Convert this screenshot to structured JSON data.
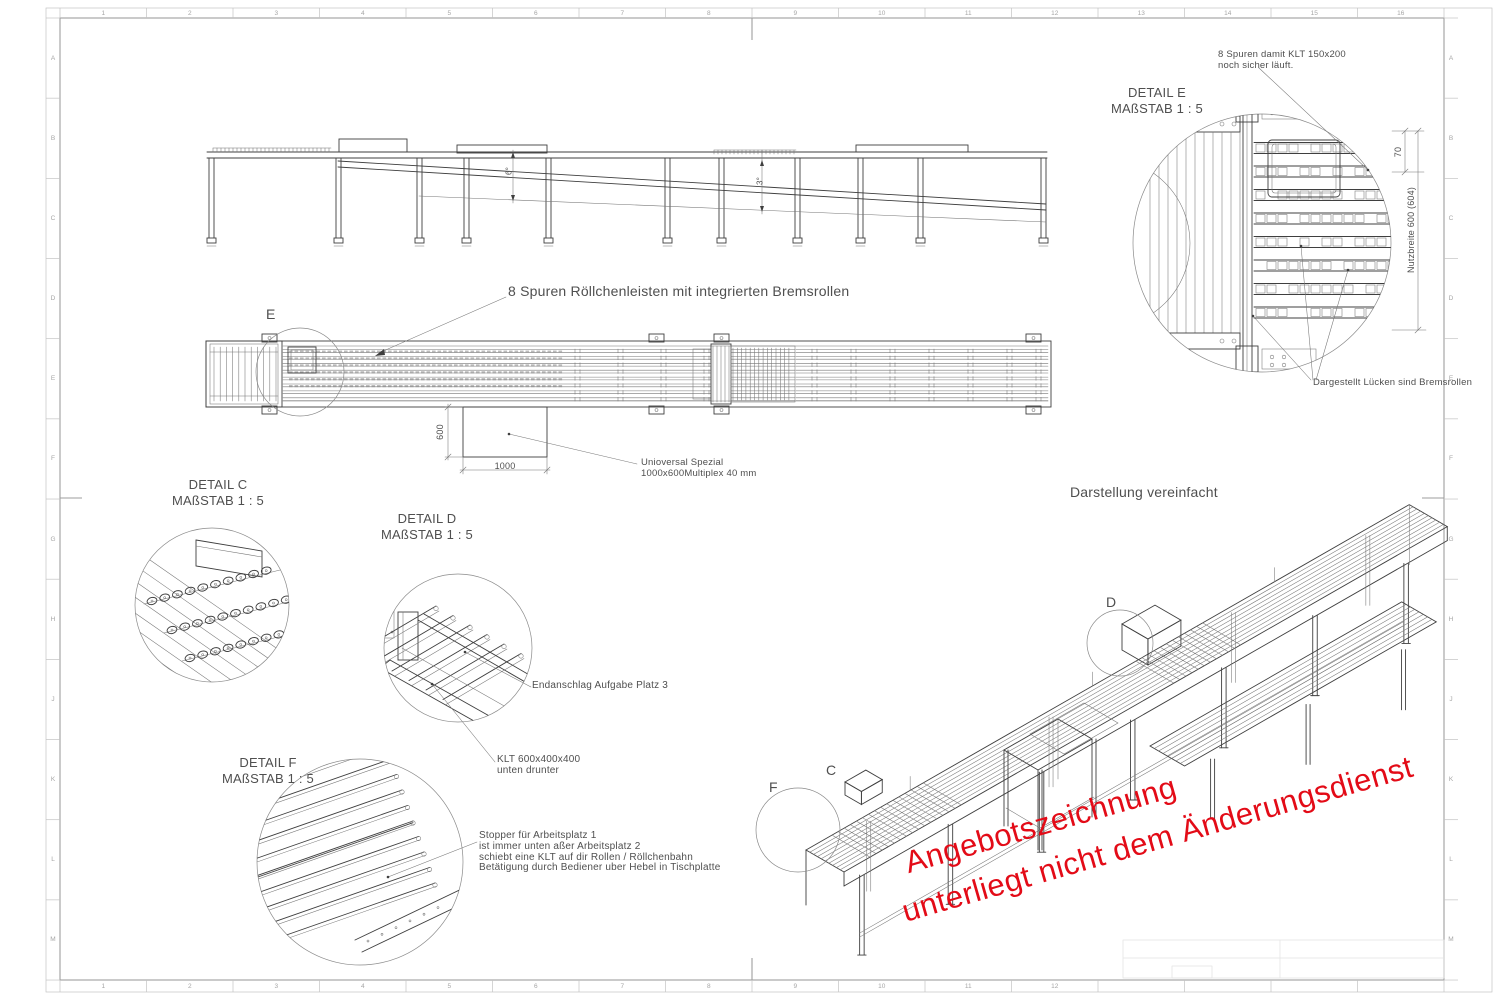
{
  "sheet": {
    "bg": "#ffffff",
    "grid_top": [
      "1",
      "2",
      "3",
      "4",
      "5",
      "6",
      "7",
      "8",
      "9",
      "10",
      "11",
      "12",
      "13",
      "14",
      "15",
      "16"
    ],
    "grid_bottom": [
      "1",
      "2",
      "3",
      "4",
      "5",
      "6",
      "7",
      "8",
      "9",
      "10",
      "11",
      "12",
      "",
      "",
      "",
      ""
    ],
    "grid_left": [
      "A",
      "B",
      "C",
      "D",
      "E",
      "F",
      "G",
      "H",
      "J",
      "K",
      "L",
      "M"
    ],
    "grid_right": [
      "A",
      "B",
      "C",
      "D",
      "E",
      "F",
      "G",
      "H",
      "J",
      "K",
      "L",
      "M"
    ]
  },
  "elevation": {
    "angle_left": "6°",
    "angle_right": "3°"
  },
  "plan": {
    "note": "8 Spuren Röllchenleisten mit integrierten Bremsrollen",
    "detail_marker": "E",
    "dim_height": "600",
    "dim_width": "1000",
    "board_note_line1": "Unioversal Spezial",
    "board_note_line2": "1000x600Multiplex 40 mm"
  },
  "detail_c": {
    "title": "DETAIL C",
    "scale": "MAßSTAB 1 : 5"
  },
  "detail_d": {
    "title": "DETAIL D",
    "scale": "MAßSTAB 1 : 5",
    "note_endanschlag": "Endanschlag Aufgabe Platz 3",
    "note_klt_line1": "KLT 600x400x400",
    "note_klt_line2": "unten drunter"
  },
  "detail_f": {
    "title": "DETAIL F",
    "scale": "MAßSTAB 1 : 5",
    "note_line1": "Stopper für Arbeitsplatz 1",
    "note_line2": "ist immer unten aßer Arbeitsplatz 2",
    "note_line3": "schiebt eine KLT auf dir Rollen / Röllchenbahn",
    "note_line4": "Betätigung durch Bediener uber Hebel in Tischplatte"
  },
  "detail_e": {
    "title": "DETAIL E",
    "scale": "MAßSTAB 1 : 5",
    "note_line1": "8 Spuren damit KLT 150x200",
    "note_line2": "noch sicher läuft.",
    "note_gaps": "Dargestellt Lücken sind Bremsrollen",
    "dim_70": "70",
    "dim_width": "Nutzbreite 600 (604)"
  },
  "iso": {
    "title": "Darstellung vereinfacht",
    "marker_d": "D",
    "marker_c": "C",
    "marker_f": "F"
  },
  "watermark": {
    "color": "#e30b17",
    "line1": "Angebotszeichnung",
    "line2": "unterliegt nicht dem Änderungsdienst"
  }
}
